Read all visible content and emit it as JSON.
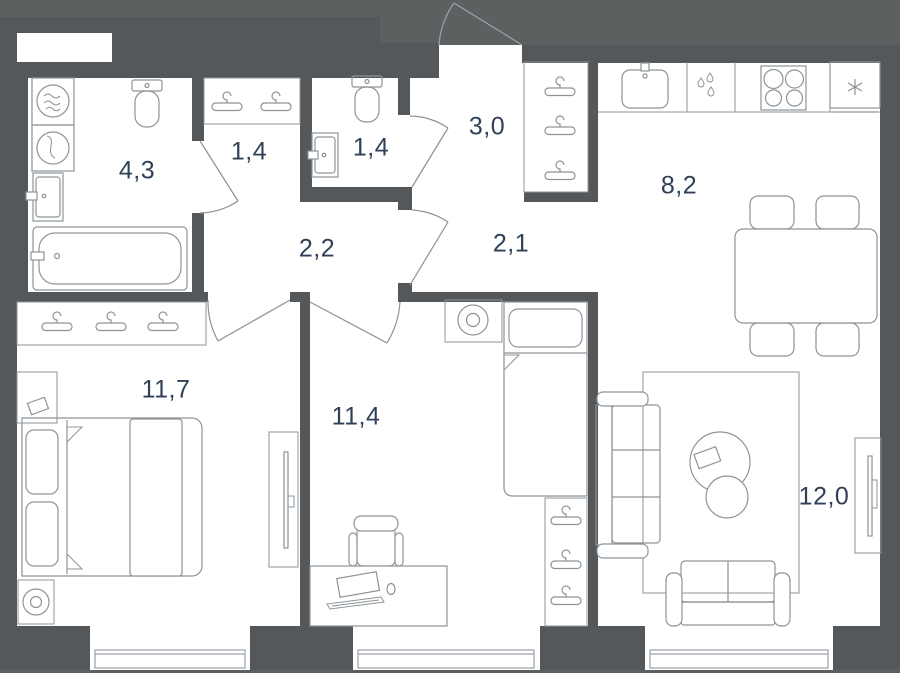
{
  "plan": {
    "title": "apartment-floor-plan",
    "colors": {
      "background": "#5d6061",
      "wall": "#54585b",
      "room_fill": "#ffffff",
      "furniture_line": "#8d9499",
      "door_line": "#9aa3a6",
      "label_text": "#2f4057"
    },
    "rooms": [
      {
        "name": "bathroom",
        "area": "4,3"
      },
      {
        "name": "closet",
        "area": "1,4"
      },
      {
        "name": "wc",
        "area": "1,4"
      },
      {
        "name": "hallway-entry",
        "area": "3,0"
      },
      {
        "name": "hallway-inner",
        "area": "2,1"
      },
      {
        "name": "hallway-left",
        "area": "2,2"
      },
      {
        "name": "kitchen",
        "area": "8,2"
      },
      {
        "name": "bedroom",
        "area": "11,7"
      },
      {
        "name": "kids-room",
        "area": "11,4"
      },
      {
        "name": "living-room",
        "area": "12,0"
      }
    ],
    "fixtures": [
      "washing-machine-icon",
      "dryer-icon",
      "bathroom-sink-icon",
      "toilet-icon",
      "bathtub-icon",
      "hanger-icon",
      "wc-toilet-icon",
      "wc-sink-icon",
      "kitchen-sink-icon",
      "dishwasher-drops-icon",
      "stove-icon",
      "fridge-snowflake-icon",
      "dining-table-icon",
      "chair-icon",
      "bed-icon",
      "nightstand-lamp-icon",
      "tv-icon",
      "wardrobe-icon",
      "desk-icon",
      "office-chair-icon",
      "sofa-icon",
      "loveseat-icon",
      "rug-icon",
      "coffee-table-icon",
      "window-icon",
      "door-swing-icon"
    ],
    "window_count": 3
  }
}
